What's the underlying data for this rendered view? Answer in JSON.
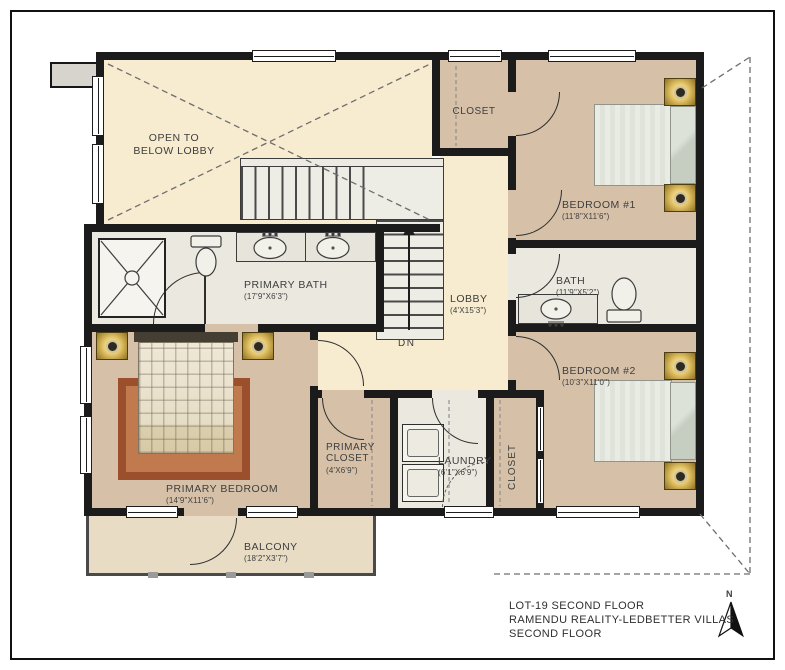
{
  "floor_plan": {
    "rooms": {
      "open_lobby": {
        "label": "OPEN TO\nBELOW LOBBY"
      },
      "closet_top": {
        "label": "CLOSET"
      },
      "bedroom_1": {
        "label": "BEDROOM #1",
        "dims": "(11'8\"X11'6\")"
      },
      "primary_bath": {
        "label": "PRIMARY BATH",
        "dims": "(17'9\"X6'3\")"
      },
      "lobby": {
        "label": "LOBBY",
        "dims": "(4'X15'3\")"
      },
      "bath": {
        "label": "BATH",
        "dims": "(11'9\"X5'2\")"
      },
      "bedroom_2": {
        "label": "BEDROOM #2",
        "dims": "(10'3\"X11'0\")"
      },
      "primary_bedroom": {
        "label": "PRIMARY BEDROOM",
        "dims": "(14'9\"X11'6\")"
      },
      "primary_closet": {
        "label": "PRIMARY\nCLOSET",
        "dims": "(4'X6'9\")"
      },
      "laundry": {
        "label": "LAUNDRY",
        "dims": "(6'1\"X6'9\")"
      },
      "closet_side": {
        "label": "CLOSET"
      },
      "balcony": {
        "label": "BALCONY",
        "dims": "(18'2\"X3'7\")"
      }
    },
    "stairs": {
      "direction_label": "DN"
    },
    "compass": {
      "label": "N"
    },
    "title_block": {
      "line1": "LOT-19  SECOND FLOOR",
      "line2": "RAMENDU REALITY-LEDBETTER VILLAS",
      "line3": "SECOND FLOOR"
    },
    "colors": {
      "wall": "#1b1b1b",
      "hall_floor": "#f7ebd0",
      "room_floor": "#d6c1a8",
      "bath_floor": "#eae8df",
      "balcony_floor": "#e8dcc5",
      "rug": "#9c4f2c",
      "nightstand_gold": "#e5c568"
    }
  }
}
